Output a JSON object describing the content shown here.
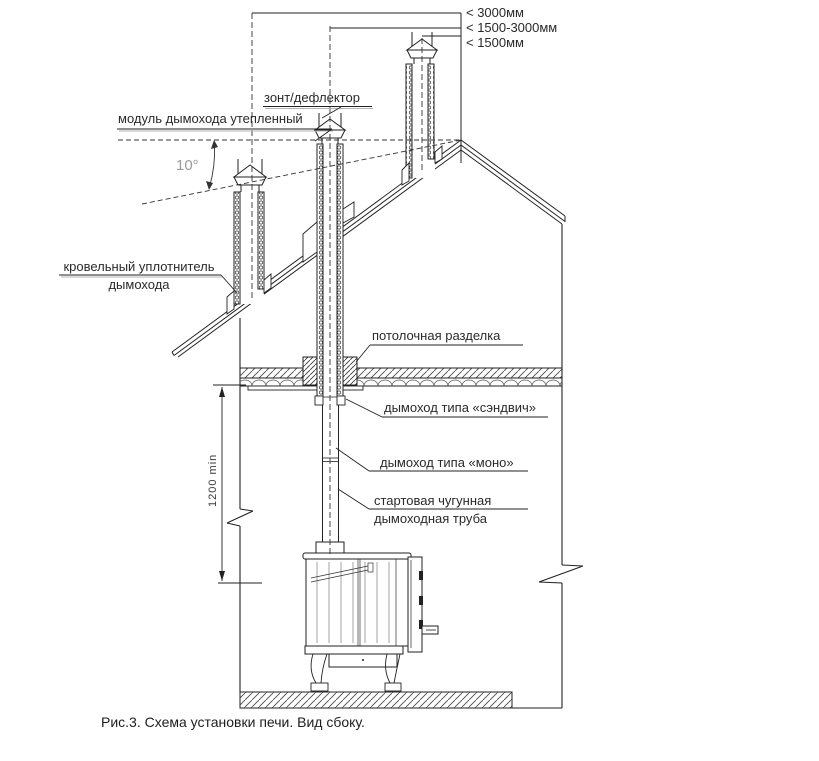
{
  "diagram": {
    "caption": "Рис.3. Схема установки печи. Вид сбоку.",
    "clearance_labels": [
      {
        "text": "< 3000мм"
      },
      {
        "text": "< 1500-3000мм"
      },
      {
        "text": "< 1500мм"
      }
    ],
    "angle_label": "10°",
    "height_dimension": "1200 min",
    "labels": {
      "cap": "зонт/дефлектор",
      "insulated_module": "модуль дымохода утепленный",
      "roof_seal_line1": "кровельный уплотнитель",
      "roof_seal_line2": "дымохода",
      "ceiling_cutout": "потолочная разделка",
      "sandwich_chimney": "дымоход типа «сэндвич»",
      "mono_chimney": "дымоход типа «моно»",
      "cast_iron_pipe_line1": "стартовая чугунная",
      "cast_iron_pipe_line2": "дымоходная труба"
    },
    "colors": {
      "ink": "#222222",
      "muted": "#9a9a9a",
      "background": "#ffffff"
    }
  }
}
